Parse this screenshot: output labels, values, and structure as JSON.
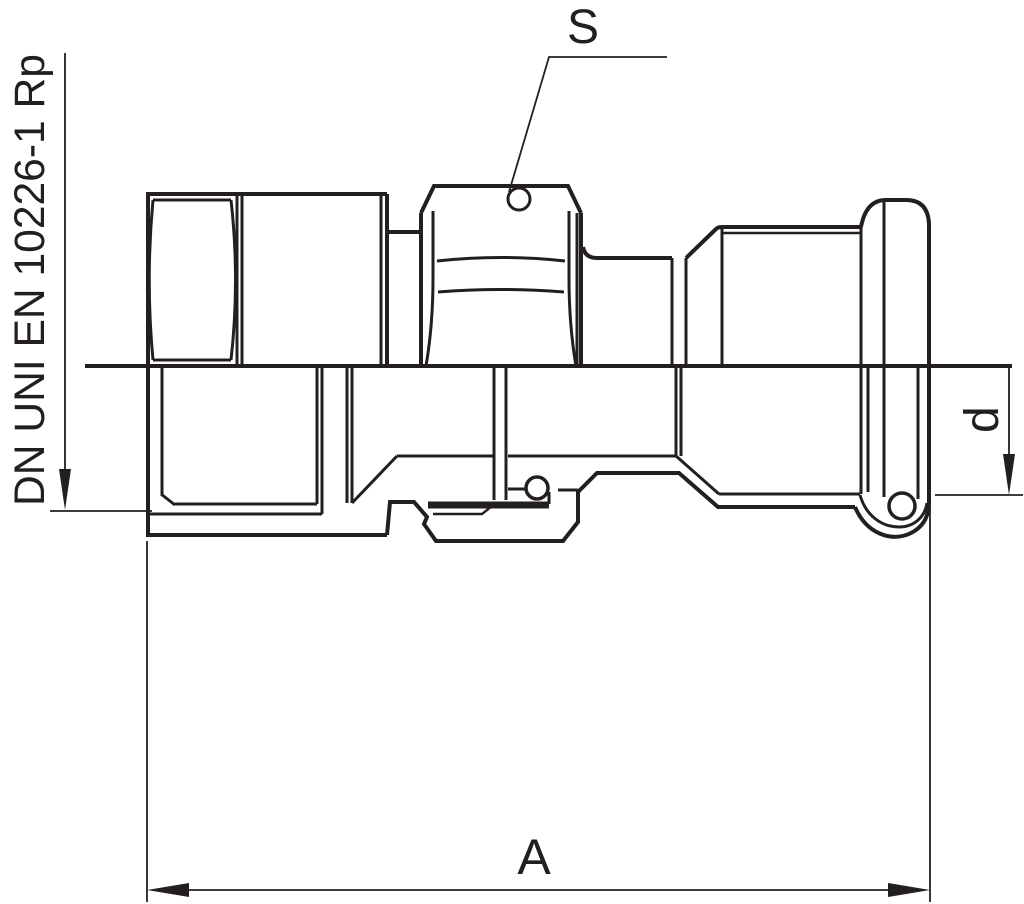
{
  "labels": {
    "thread_standard": "DN UNI EN 10226-1 Rp",
    "wrench_size": "S",
    "tube_diameter": "d",
    "overall_length": "A"
  },
  "colors": {
    "line": "#231f20",
    "background": "#ffffff"
  }
}
